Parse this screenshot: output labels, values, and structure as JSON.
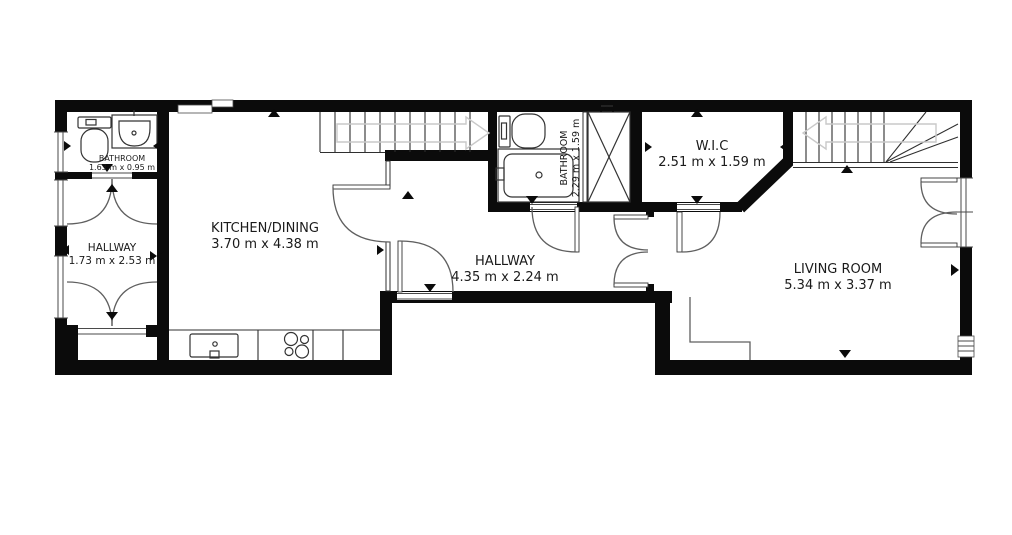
{
  "rooms": {
    "bathroom1": {
      "name": "BATHROOM",
      "dims": "1.63 m x 0.95 m"
    },
    "hallway1": {
      "name": "HALLWAY",
      "dims": "1.73 m x 2.53 m"
    },
    "kitchen": {
      "name": "KITCHEN/DINING",
      "dims": "3.70 m x 4.38 m"
    },
    "hallway2": {
      "name": "HALLWAY",
      "dims": "4.35 m x 2.24 m"
    },
    "bathroom2": {
      "name": "BATHROOM",
      "dims": "2.29 m x 1.59 m"
    },
    "wic": {
      "name": "W.I.C",
      "dims": "2.51 m x 1.59 m"
    },
    "living": {
      "name": "LIVING ROOM",
      "dims": "5.34 m x 3.37 m"
    }
  },
  "colors": {
    "wall": "#0b0b0b",
    "line": "#2f2f2f",
    "door_arc": "#5f5f5f",
    "faded_arrow": "#c9c9c9",
    "text": "#1a1a1a",
    "background": "#ffffff"
  }
}
